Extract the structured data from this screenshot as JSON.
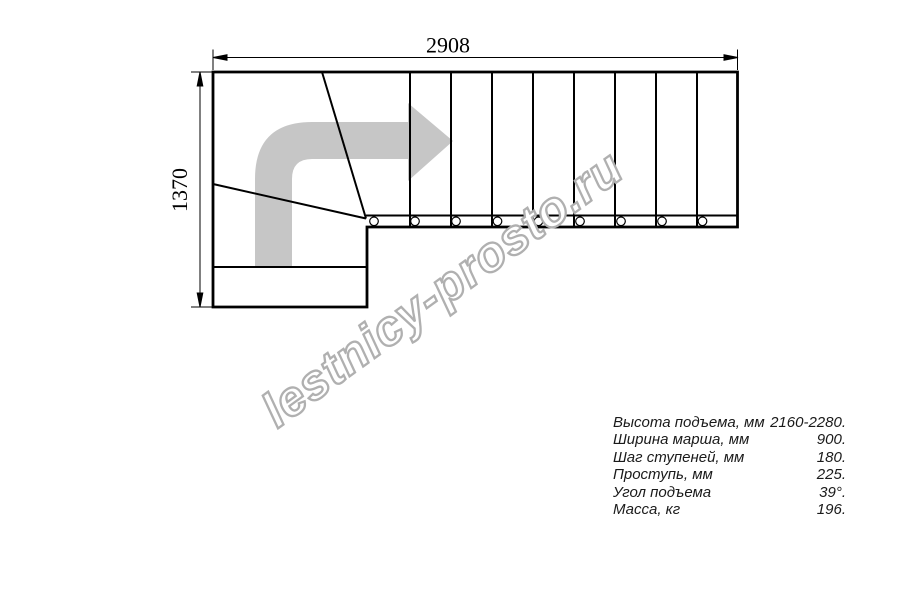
{
  "drawing": {
    "dimension_top": "2908",
    "dimension_left": "1370",
    "type": "L-shaped staircase plan view with winder steps"
  },
  "watermark": {
    "text": "lestnicy-prosto.ru"
  },
  "specs": {
    "rows": [
      {
        "label": "Высота подъема, мм",
        "value": "2160-2280."
      },
      {
        "label": "Ширина марша, мм",
        "value": "900."
      },
      {
        "label": "Шаг ступеней, мм",
        "value": "180."
      },
      {
        "label": "Проступь, мм",
        "value": "225."
      },
      {
        "label": "Угол подъема",
        "value": "39°."
      },
      {
        "label": "Масса, кг",
        "value": "196."
      }
    ]
  },
  "icons": {
    "direction_arrow": "curved-right-up-arrow"
  },
  "colors": {
    "line": "#000000",
    "direction_arrow": "#c6c6c6",
    "watermark_outline": "#b0b0b0",
    "background": "#ffffff"
  }
}
